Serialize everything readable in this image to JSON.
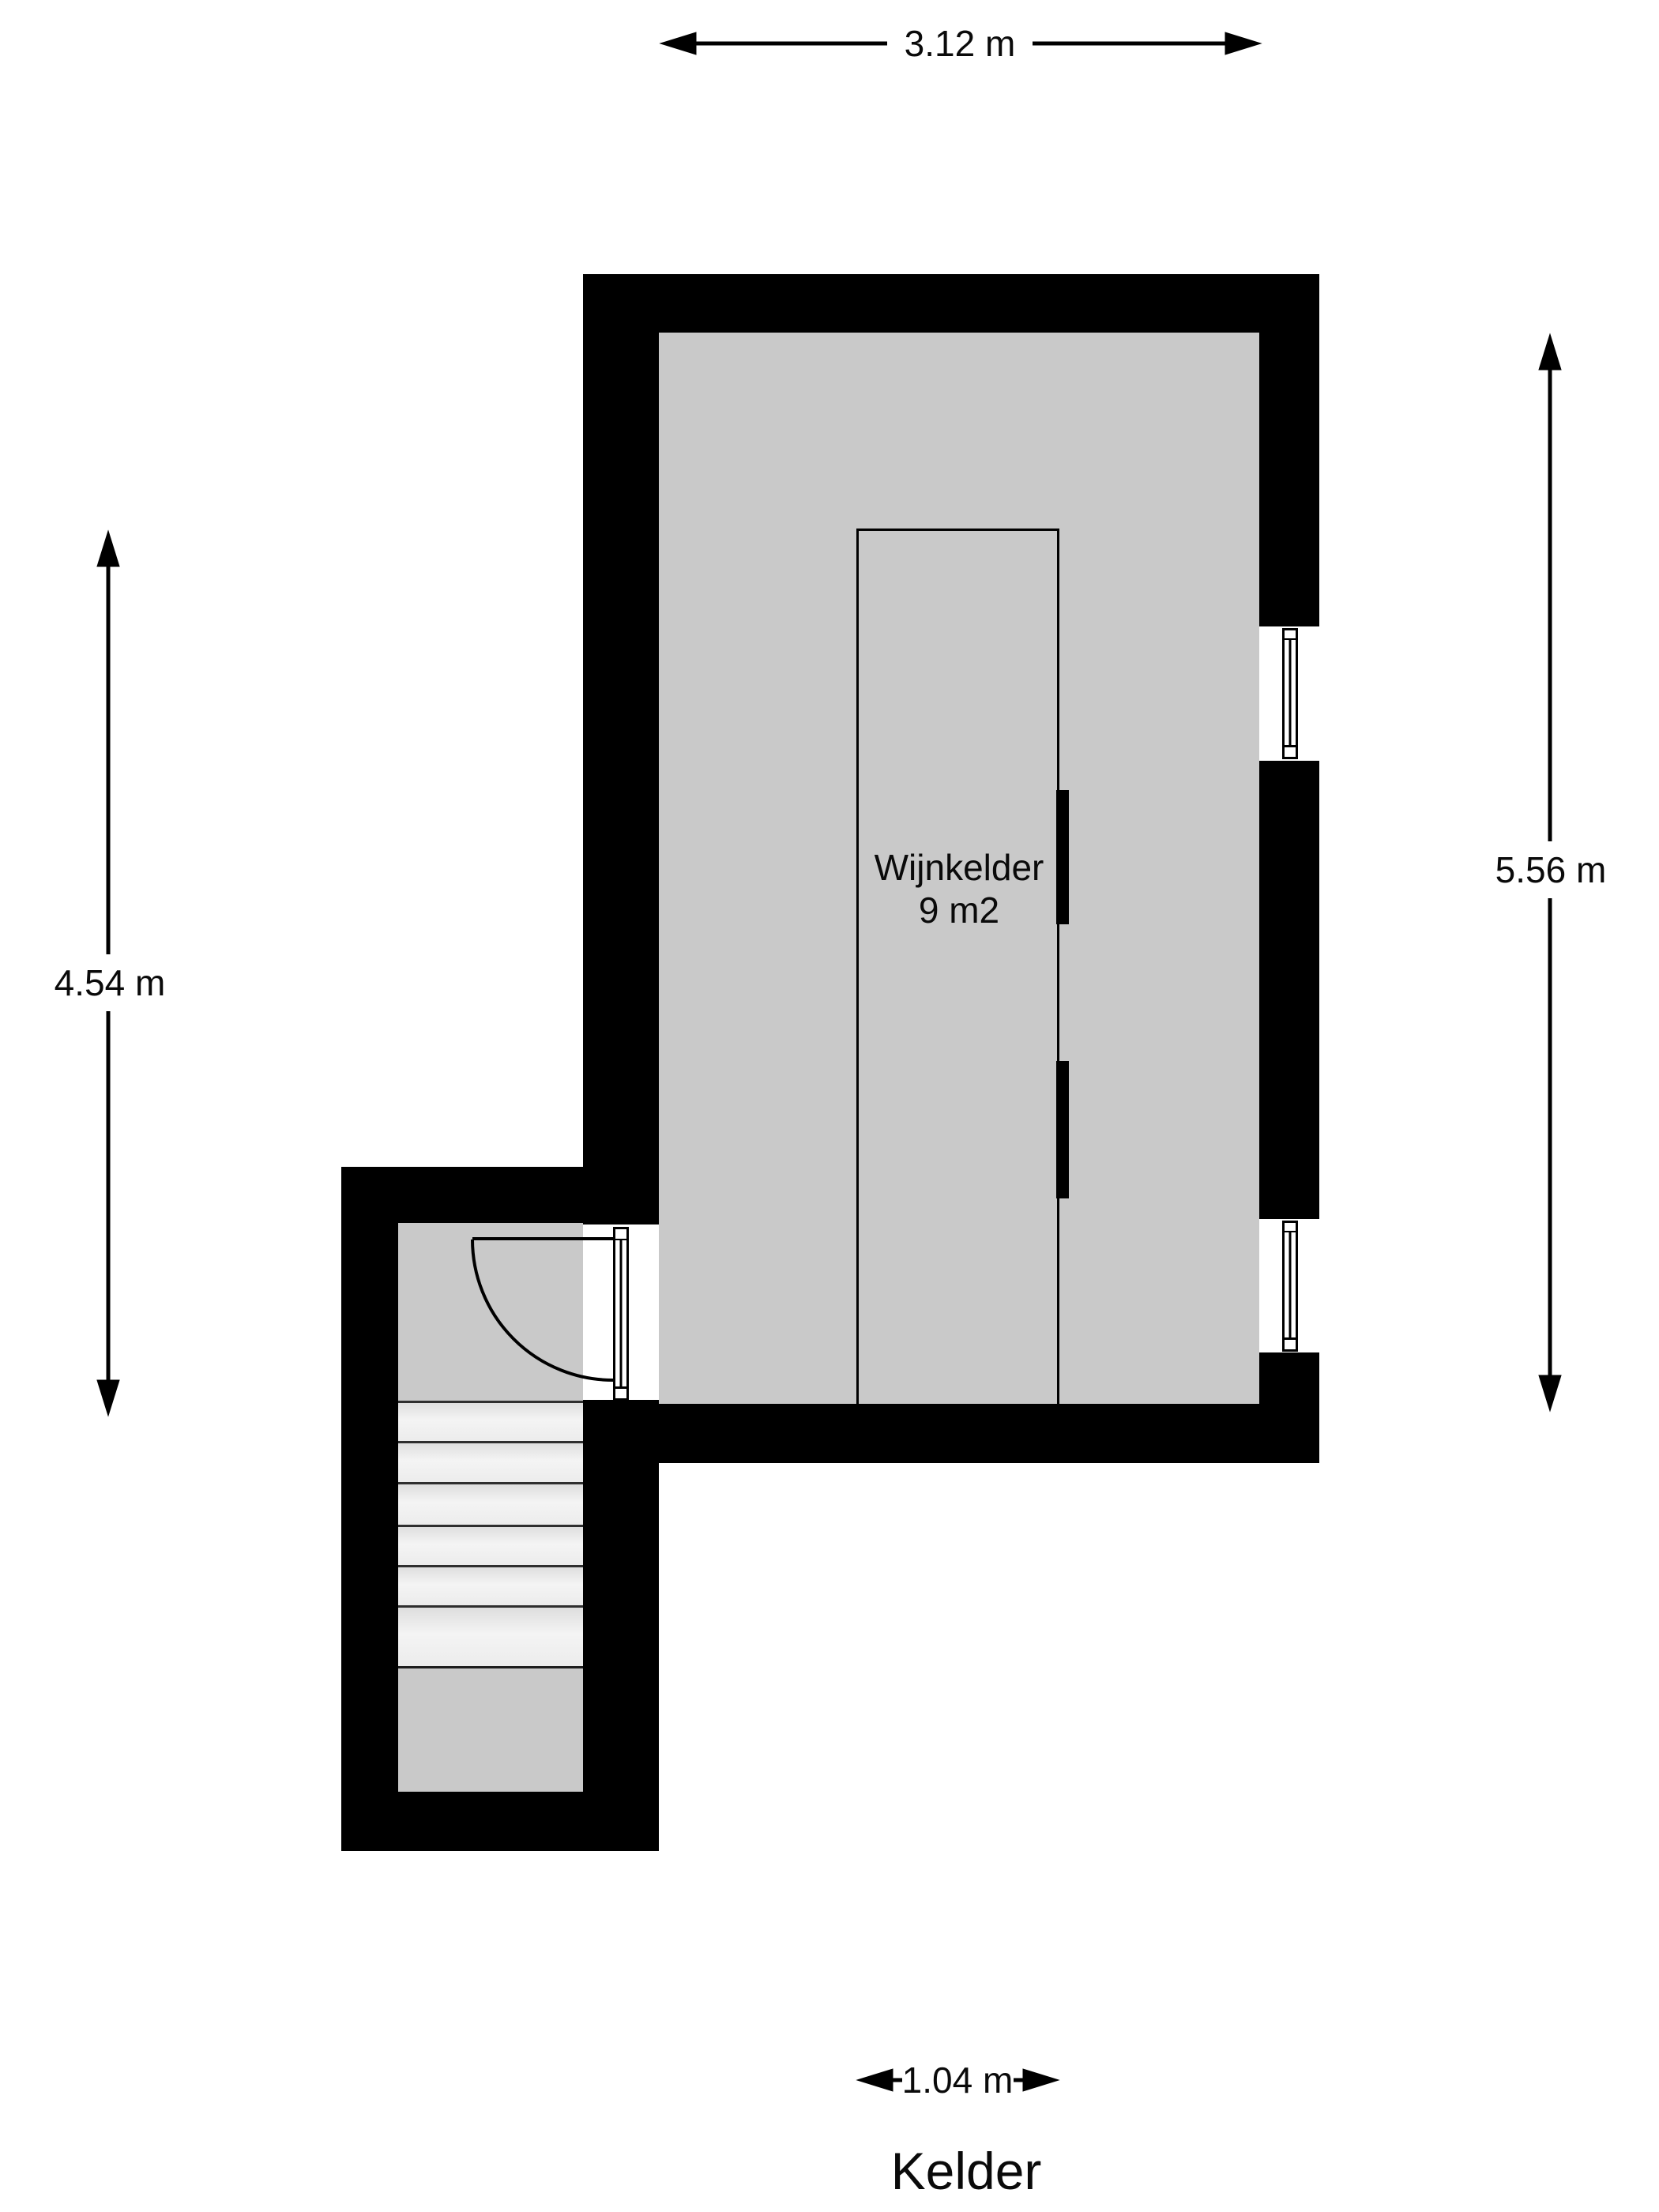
{
  "title": "Kelder",
  "room": {
    "name": "Wijnkelder",
    "area": "9 m2"
  },
  "dimensions": {
    "top": "3.12 m",
    "left": "4.54 m",
    "right": "5.56 m",
    "closet_width": "1.04 m"
  },
  "colors": {
    "wall": "#000000",
    "floor": "#c9c9c9",
    "stairs": "#ececec",
    "background": "#ffffff",
    "text": "#0a0a0a"
  },
  "features": {
    "stair_tread_count": 6,
    "windows": 2,
    "doors": 1
  }
}
